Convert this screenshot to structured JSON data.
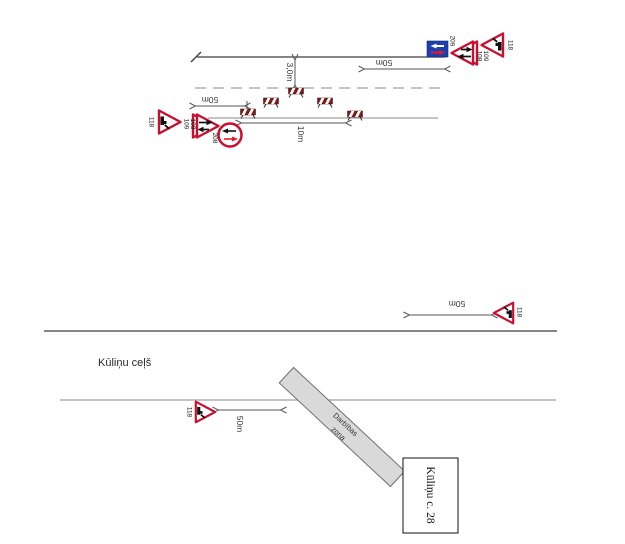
{
  "colors": {
    "sign_red": "#c8102e",
    "barrier_red": "#7d1b1b",
    "sign_blue": "#1c3fae",
    "arrow_red": "#e8192c",
    "work_zone_fill": "#d9d9d9",
    "road_line_dark": "#3f3f3f",
    "road_line_light": "#8a8a8a",
    "dimension_gray": "#555555"
  },
  "top_diagram": {
    "left_group": {
      "sign_118": "118",
      "sign_109": "109",
      "sign_108": "108",
      "sign_208": "208"
    },
    "right_group": {
      "sign_209": "209",
      "sign_108": "108",
      "sign_109": "109",
      "sign_118": "118"
    },
    "measurements": {
      "lane_width": "3,0m",
      "left_distance": "50m",
      "right_distance": "50m",
      "zone_length": "10m"
    }
  },
  "bottom_diagram": {
    "road_name": "Kūliņu ceļš",
    "left_sign_118": "118",
    "right_sign_118": "118",
    "left_distance": "50m",
    "right_distance": "50m",
    "work_zone": {
      "label_line1": "Darbības",
      "label_line2": "zona"
    },
    "building_label": "Kūliņu c. 28"
  }
}
